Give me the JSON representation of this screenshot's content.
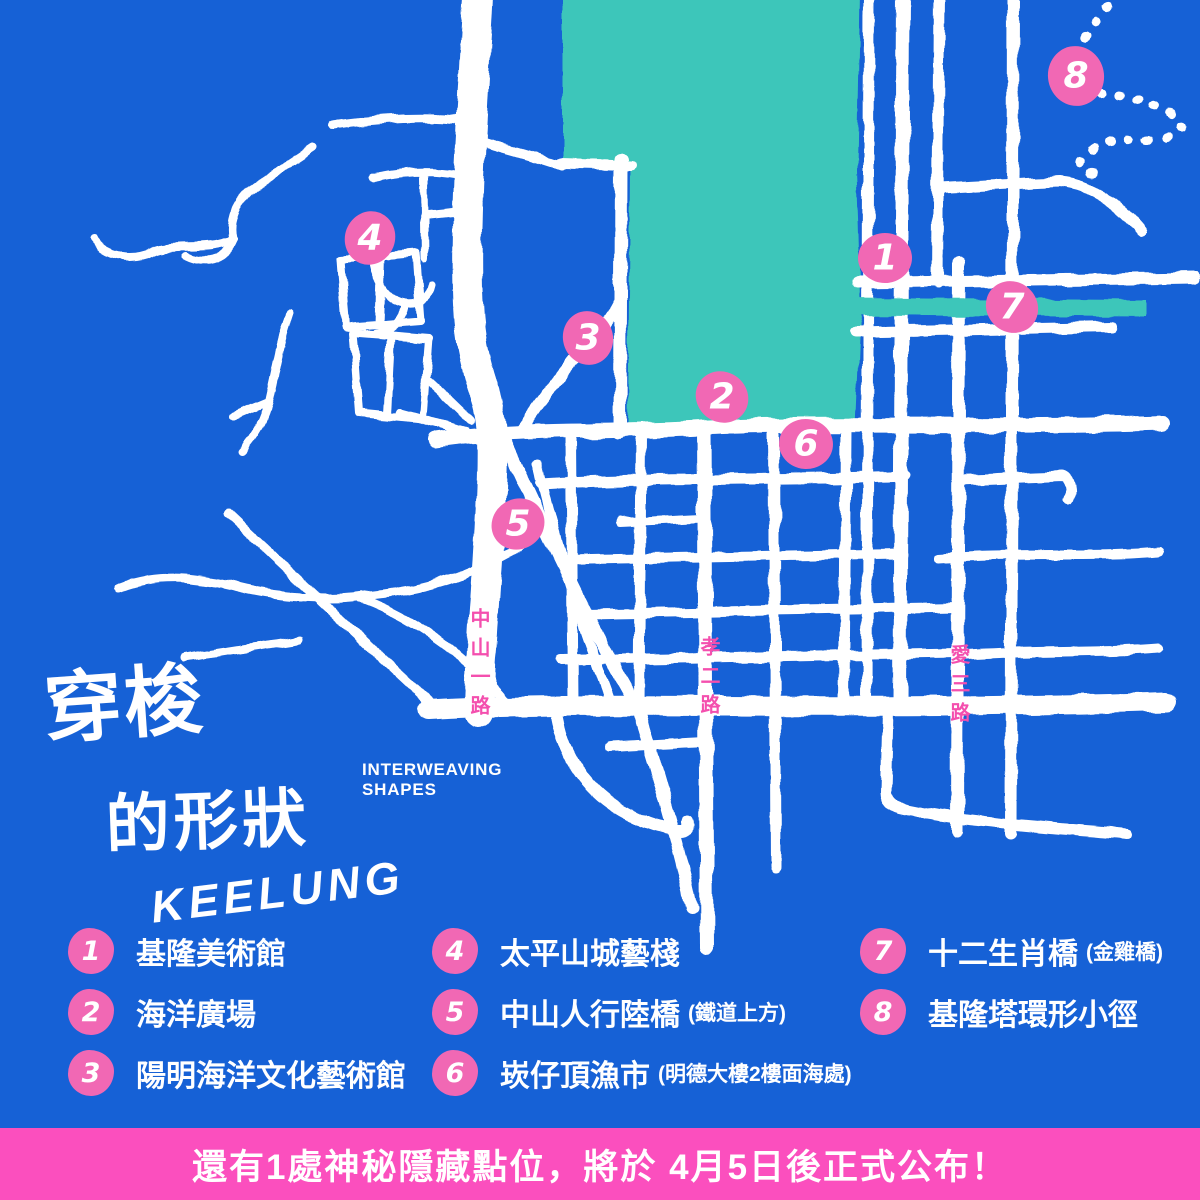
{
  "title": {
    "line1": "穿梭",
    "line2": "的形狀",
    "latin": "KEELUNG",
    "subtitle_line1": "INTERWEAVING",
    "subtitle_line2": "SHAPES"
  },
  "map": {
    "road_labels": [
      {
        "name": "中山一路"
      },
      {
        "name": "孝二路"
      },
      {
        "name": "愛三路"
      }
    ],
    "markers": [
      {
        "number": "1",
        "x": 885,
        "y": 258
      },
      {
        "number": "2",
        "x": 722,
        "y": 397
      },
      {
        "number": "3",
        "x": 588,
        "y": 338
      },
      {
        "number": "4",
        "x": 370,
        "y": 238
      },
      {
        "number": "5",
        "x": 518,
        "y": 524
      },
      {
        "number": "6",
        "x": 806,
        "y": 444
      },
      {
        "number": "7",
        "x": 1012,
        "y": 307
      },
      {
        "number": "8",
        "x": 1076,
        "y": 76
      }
    ]
  },
  "legend": {
    "columns": [
      {
        "items": [
          {
            "number": "1",
            "label": "基隆美術館",
            "note": ""
          },
          {
            "number": "2",
            "label": "海洋廣場",
            "note": ""
          },
          {
            "number": "3",
            "label": "陽明海洋文化藝術館",
            "note": ""
          }
        ]
      },
      {
        "items": [
          {
            "number": "4",
            "label": "太平山城藝棧",
            "note": ""
          },
          {
            "number": "5",
            "label": "中山人行陸橋",
            "note": "(鐵道上方)"
          },
          {
            "number": "6",
            "label": "崁仔頂漁市",
            "note": "(明德大樓2樓面海處)"
          }
        ]
      },
      {
        "items": [
          {
            "number": "7",
            "label": "十二生肖橋",
            "note": "(金雞橋)"
          },
          {
            "number": "8",
            "label": "基隆塔環形小徑",
            "note": ""
          }
        ]
      }
    ]
  },
  "banner": {
    "text": "還有1處神秘隱藏點位，將於 4月5日後正式公布！"
  },
  "colors": {
    "background": "#1661d6",
    "water": "#3cc6ba",
    "road": "#ffffff",
    "marker_pink": "#f168b4",
    "banner_pink": "#fb4fbe",
    "street_label_pink": "#f44fae"
  }
}
